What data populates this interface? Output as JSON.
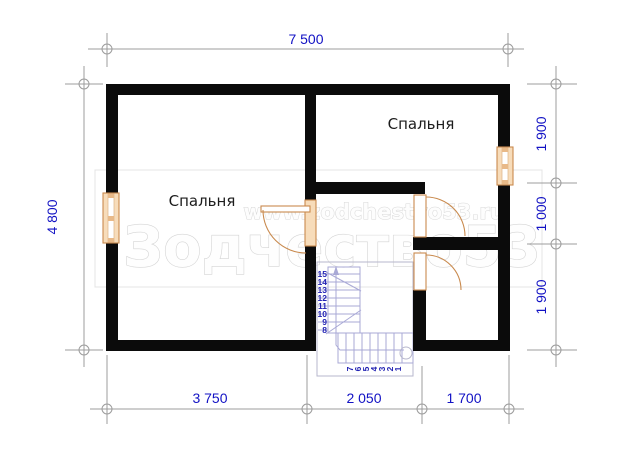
{
  "plan": {
    "type": "floor-plan",
    "rooms": {
      "bedroom_left": {
        "label": "Спальня"
      },
      "bedroom_right": {
        "label": "Спальня"
      }
    },
    "dimensions": {
      "top": "7 500",
      "left": "4 800",
      "right": [
        "1 900",
        "1 000",
        "1 900"
      ],
      "bottom": [
        "3 750",
        "2 050",
        "1 700"
      ]
    },
    "stairs": {
      "upper": [
        "15",
        "14",
        "13",
        "12",
        "11",
        "10",
        "9",
        "8"
      ],
      "lower": [
        "7",
        "6",
        "5",
        "4",
        "3",
        "2",
        "1"
      ]
    }
  },
  "watermark": {
    "site": "www.zodchestvo53.ru",
    "brand": "Зодчество53"
  },
  "colors": {
    "dimension_text": "#1212c4",
    "axis_lines": "#9c9c9c",
    "walls": "#0b0b0b",
    "joinery_stroke": "#c98a4e",
    "joinery_fill": "#f7dcba",
    "stair_lines": "#a9a9d6",
    "stair_numbers": "#2424b4",
    "room_label": "#1c1c1c",
    "watermark": "#d4d4d4"
  }
}
